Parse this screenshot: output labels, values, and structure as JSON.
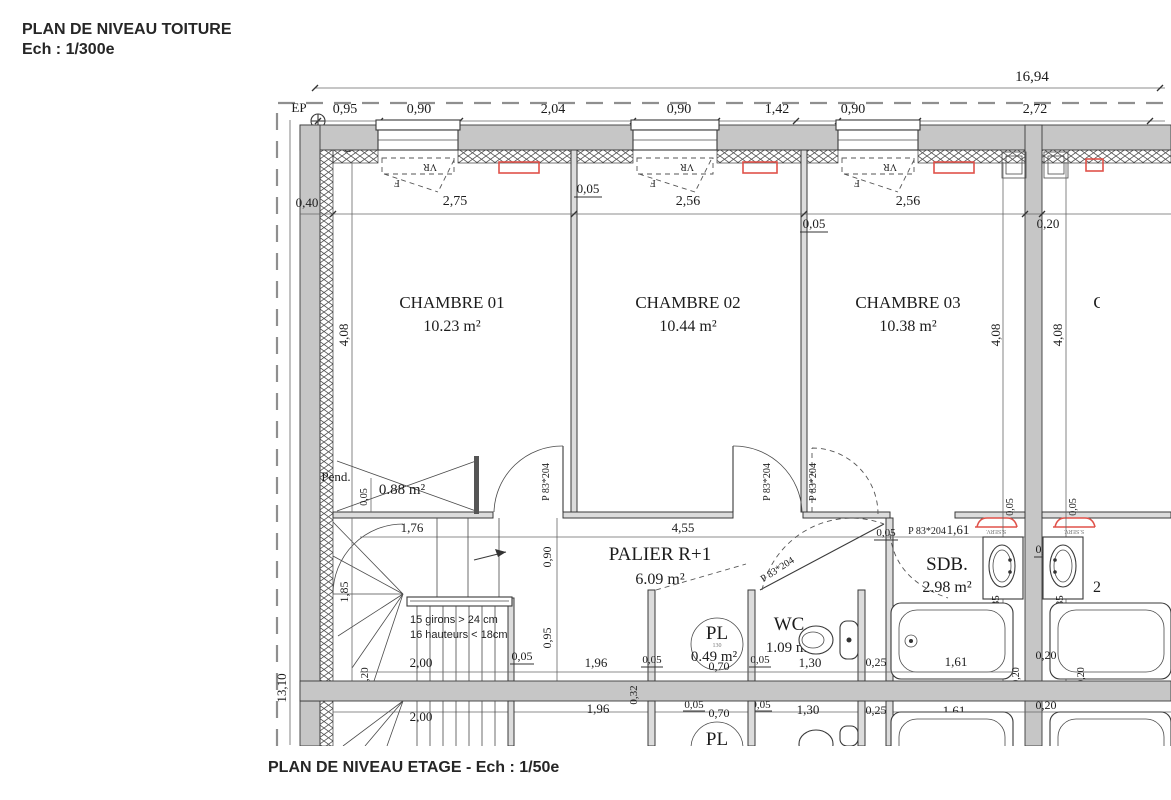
{
  "titles": {
    "roof": "PLAN DE NIVEAU TOITURE",
    "roof_scale": "Ech : 1/300e",
    "floor": "PLAN DE NIVEAU ETAGE - Ech : 1/50e"
  },
  "rooms": {
    "chambre1": {
      "name": "CHAMBRE 01",
      "area": "10.23 m²"
    },
    "chambre2": {
      "name": "CHAMBRE 02",
      "area": "10.44 m²"
    },
    "chambre3": {
      "name": "CHAMBRE 03",
      "area": "10.38 m²"
    },
    "palier": {
      "name": "PALIER R+1",
      "area": "6.09 m²"
    },
    "sdb": {
      "name": "SDB.",
      "area": "2.98 m²"
    },
    "wc": {
      "name": "WC",
      "area": "1.09 m²"
    },
    "pl": {
      "name": "PL",
      "area": "0.49 m²",
      "tank_label": "130"
    },
    "pente": {
      "name": "Pend.",
      "area": "0.88 m²"
    },
    "mirror": {
      "sdb_partial": "2",
      "chambre_partial": "C",
      "pl": "PL"
    }
  },
  "stairs": {
    "note1": "15 girons > 24 cm",
    "note2": "16 hauteurs < 18cm"
  },
  "labels": {
    "ep": "EP",
    "vr": "VR",
    "f": "F",
    "door": "P 83*204",
    "serv": "S.SERV."
  },
  "dims": {
    "overall": "16,94",
    "d095": "0,95",
    "d090": "0,90",
    "d204": "2,04",
    "d142": "1,42",
    "d272": "2,72",
    "d040": "0,40",
    "d275": "2,75",
    "d005": "0,05",
    "d256": "2,56",
    "d020": "0,20",
    "d408": "4,08",
    "d176": "1,76",
    "d455": "4,55",
    "d185": "1,85",
    "d200": "2,00",
    "d196": "1,96",
    "d032": "0,32",
    "d070": "0,70",
    "d130": "1,30",
    "d025": "0,25",
    "d161": "1,61",
    "d1310": "13,10"
  },
  "colors": {
    "wall": "#c6c6c6",
    "line": "#3a3a3a",
    "dim_line": "#666666",
    "red_accent": "#e0524a",
    "boundary": "#8f8f8f"
  }
}
